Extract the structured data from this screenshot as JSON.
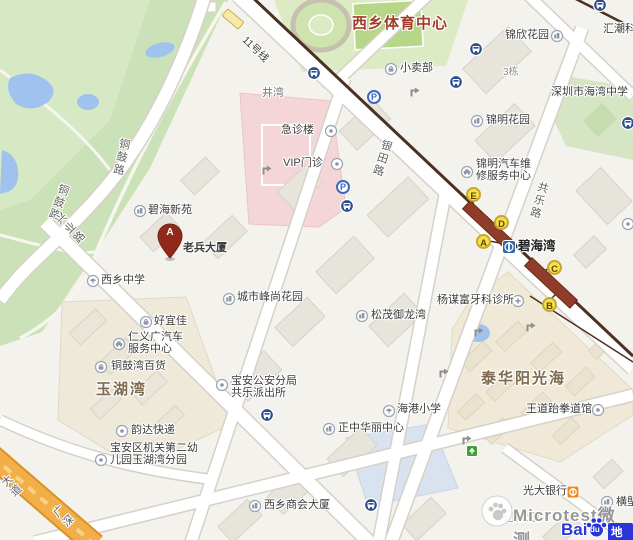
{
  "colors": {
    "road_fill": "#ffffff",
    "road_casing": "#d5d1c8",
    "park_green": "#cbe2b8",
    "water_blue": "#9fc3ee",
    "hospital_pink": "#f5d6d8",
    "residential_beige": "#f0e9d7",
    "metro_line_brown": "#4a3120",
    "metro_platform_red": "#8f3c2a",
    "exit_badge_yellow": "#f7df4e",
    "highway_orange": "#f2ae49",
    "aoi_label_brown": "#7d6a50",
    "sports_label_red": "#a23c28",
    "bus_icon_blue": "#2c4d8e",
    "baidu_blue": "#2a35d8"
  },
  "map": {
    "area_labels": {
      "sports_center": "西乡体育中心",
      "yuhuwan": "玉湖湾",
      "taihua": "泰华阳光海"
    },
    "road_labels": {
      "tonggu_a": "铜鼓路",
      "tonggu_b": "铜鼓路",
      "xingye": "兴业路",
      "yintian": "银田路",
      "gongle": "共乐路",
      "dadao_partial": "大道",
      "guangshen_partial": "广深"
    },
    "metro": {
      "line_label": "11号线",
      "station_name": "碧海湾",
      "exits": [
        "A",
        "B",
        "C",
        "D",
        "E"
      ]
    },
    "marker": {
      "letter": "A",
      "label": "老兵大厦"
    },
    "parking_label": "P",
    "pois": [
      {
        "text": "小卖部",
        "icon": "shop-icon"
      },
      {
        "text": "锦欣花园",
        "icon": "building-icon"
      },
      {
        "text": "深圳市海湾中学",
        "icon": "none"
      },
      {
        "text": "锦明花园",
        "icon": "building-icon"
      },
      {
        "text": "急诊楼",
        "icon": "dot-icon"
      },
      {
        "text": "VIP门诊",
        "icon": "dot-icon"
      },
      {
        "lines": [
          "锦明汽车维",
          "修服务中心"
        ],
        "icon": "car-icon"
      },
      {
        "text": "碧海新苑",
        "icon": "building-icon"
      },
      {
        "text": "西乡中学",
        "icon": "school-icon"
      },
      {
        "text": "好宜佳",
        "icon": "shop-icon"
      },
      {
        "lines": [
          "仁义广汽车",
          "服务中心"
        ],
        "icon": "car-icon"
      },
      {
        "text": "铜鼓湾百货",
        "icon": "shop-icon"
      },
      {
        "text": "韵达快递",
        "icon": "dot-icon"
      },
      {
        "lines": [
          "宝安区机关第二幼",
          "儿园玉湖湾分园"
        ],
        "icon": "dot-icon"
      },
      {
        "lines": [
          "宝安公安分局",
          "共乐派出所"
        ],
        "icon": "dot-icon"
      },
      {
        "text": "城市峰尚花园",
        "icon": "building-icon"
      },
      {
        "text": "松茂御龙湾",
        "icon": "building-icon"
      },
      {
        "text": "海港小学",
        "icon": "school-icon"
      },
      {
        "text": "正中华丽中心",
        "icon": "building-icon"
      },
      {
        "text": "西乡商会大厦",
        "icon": "building-icon"
      },
      {
        "text": "杨谋富牙科诊所",
        "icon": "cross-icon"
      },
      {
        "text": "王道跆拳道馆",
        "icon": "dot-icon"
      },
      {
        "text": "光大银行",
        "icon": "bank-icon"
      },
      {
        "text": "横塱",
        "icon": "building-icon"
      },
      {
        "text": "井湾",
        "icon": "none"
      },
      {
        "text": "3栋",
        "icon": "none"
      },
      {
        "text": "汇潮科技",
        "icon": "none"
      },
      {
        "text": "海上大厦",
        "icon": "none"
      }
    ]
  },
  "watermark": {
    "text": "Microtest微测"
  },
  "logo": {
    "bai": "Bai",
    "du": "du",
    "ditu": "地图"
  }
}
